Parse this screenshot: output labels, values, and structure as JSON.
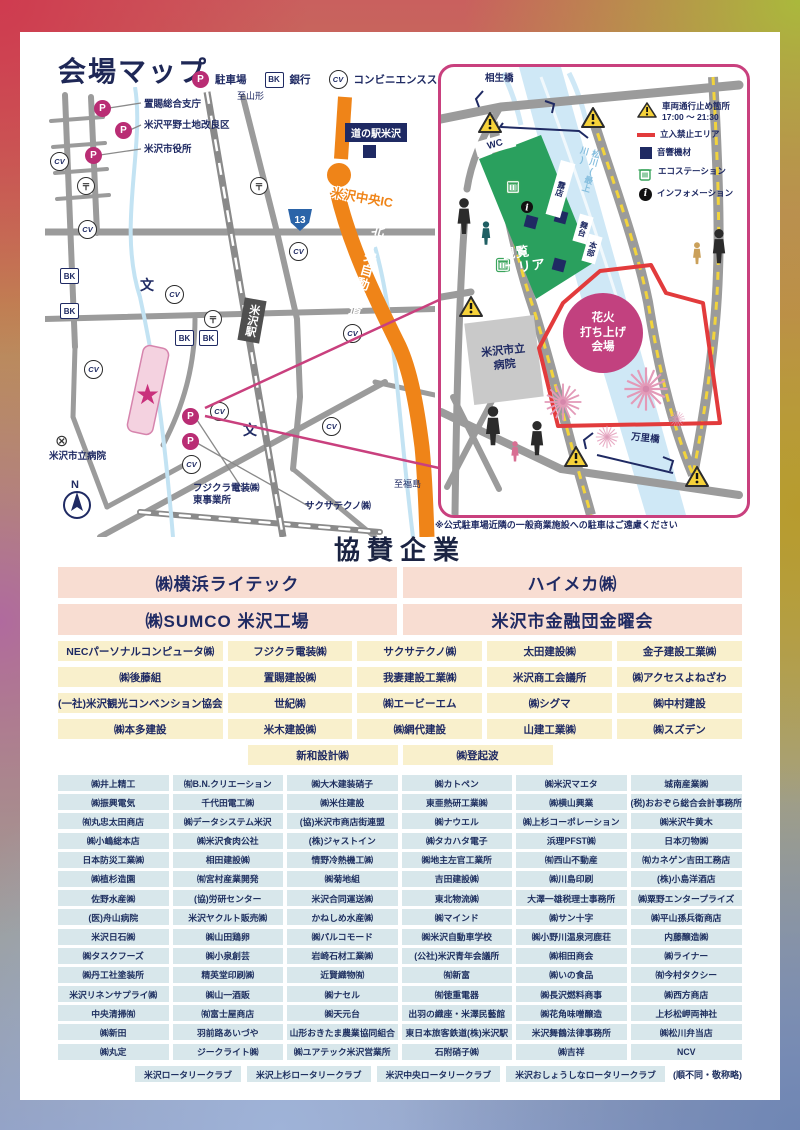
{
  "header": {
    "title": "会場マップ",
    "legend": [
      {
        "icon": "P",
        "label": "駐車場"
      },
      {
        "icon": "BK",
        "label": "銀行"
      },
      {
        "icon": "CV",
        "label": "コンビニエンスストア"
      }
    ]
  },
  "left_map": {
    "to_yamagata": "至山形",
    "to_fukushima": "至福島",
    "okitama": "置賜総合支庁",
    "kairyoku": "米沢平野土地改良区",
    "cityhall": "米沢市役所",
    "michinoeki": "道の駅米沢",
    "ic": "米沢中央IC",
    "expressway": "東北中央自動車道",
    "route13": "13",
    "station": "米沢駅",
    "hospital_label": "米沢市立病院",
    "fujikura": "フジクラ電装㈱\n東事業所",
    "saxa": "サクサテクノ㈱",
    "north": "N",
    "symbols": {
      "p": "P",
      "bk": "BK",
      "cv": "CV",
      "post": "〒",
      "school": "文",
      "hospital": "⊗",
      "star": "★"
    }
  },
  "inset_map": {
    "aioi": "相生橋",
    "banri": "万里橋",
    "wc": "WC",
    "roten": "露店",
    "stage": "舞台",
    "hq": "本部",
    "river": "松川(最上川)",
    "kanran": "観覧\nエリア",
    "hanabi": "花火\n打ち上げ\n会場",
    "hospital": "米沢市立\n病院",
    "legend": [
      {
        "label": "車両通行止め箇所",
        "sub": "17:00 〜 21:30"
      },
      {
        "label": "立入禁止エリア"
      },
      {
        "label": "音響機材"
      },
      {
        "label": "エコステーション"
      },
      {
        "label": "インフォメーション"
      }
    ],
    "note": "※公式駐車場近隣の一般商業施設への駐車はご遠慮ください"
  },
  "sponsors": {
    "title": "協賛企業",
    "tier1": [
      "㈱横浜ライテック",
      "ハイメカ㈱",
      "㈱SUMCO 米沢工場",
      "米沢市金融団金曜会"
    ],
    "tier2": [
      "NECパーソナルコンピュータ㈱",
      "フジクラ電装㈱",
      "サクサテクノ㈱",
      "太田建設㈱",
      "金子建設工業㈱",
      "㈱後藤組",
      "置賜建設㈱",
      "我妻建設工業㈱",
      "米沢商工会議所",
      "㈱アクセスよねざわ",
      "(一社)米沢観光コンベンション協会",
      "世紀㈱",
      "㈱エービーエム",
      "㈱シグマ",
      "㈱中村建設",
      "㈱本多建設",
      "米木建設㈱",
      "㈱網代建設",
      "山建工業㈱",
      "㈱スズデン"
    ],
    "tier2b": [
      "新和設計㈱",
      "㈱登起波"
    ],
    "tier3": [
      "㈱井上精工",
      "㈲B.N.クリエーション",
      "㈱大木建装硝子",
      "㈱カトペン",
      "㈱米沢マエタ",
      "城南産業㈱",
      "㈱振興電気",
      "千代田電工㈱",
      "㈱米住建設",
      "東亜熱研工業㈱",
      "㈱横山興業",
      "(税)おおぞら総合会計事務所",
      "㈲丸忠太田商店",
      "㈱データシステム米沢",
      "(協)米沢市商店街連盟",
      "㈱ナウエル",
      "㈱上杉コーポレーション",
      "㈱米沢牛黄木",
      "㈱小嶋総本店",
      "㈱米沢食肉公社",
      "(株)ジャストイン",
      "㈱タカハタ電子",
      "浜理PFST㈱",
      "日本刃物㈱",
      "日本防災工業㈱",
      "相田建設㈱",
      "情野冷熱機工㈱",
      "㈱地主左官工業所",
      "㈲西山不動産",
      "㈲カネゲン吉田工務店",
      "㈱植杉造園",
      "㈲宮村産業開発",
      "㈱菊地組",
      "吉田建設㈱",
      "㈱川島印刷",
      "(株)小島洋酒店",
      "佐野水産㈱",
      "(協)労研センター",
      "米沢合同運送㈱",
      "東北物流㈱",
      "大澤一雄税理士事務所",
      "㈱粟野エンタープライズ",
      "(医)舟山病院",
      "米沢ヤクルト販売㈱",
      "かねしめ水産㈱",
      "㈱マインド",
      "㈱サン十字",
      "㈱平山孫兵衛商店",
      "米沢日石㈱",
      "㈱山田鶏卵",
      "㈱パルコモード",
      "㈱米沢自動車学校",
      "㈱小野川温泉河鹿荘",
      "内藤醸造㈱",
      "㈱タスクフーズ",
      "㈱小泉創芸",
      "岩崎石材工業㈱",
      "(公社)米沢青年会議所",
      "㈱相田商会",
      "㈱ライナー",
      "㈱丹工社塗装所",
      "精英堂印刷㈱",
      "近賢織物㈲",
      "㈲新富",
      "㈱いの食品",
      "㈲今村タクシー",
      "米沢リネンサプライ㈱",
      "㈱山一酒販",
      "㈱ナセル",
      "㈲徳重電器",
      "㈱長沢燃料商事",
      "㈱西方商店",
      "中央清掃㈲",
      "㈲富士屋商店",
      "㈱天元台",
      "出羽の織座・米澤民藝館",
      "㈱花角味噌醸造",
      "上杉松岬両神社",
      "㈱新田",
      "羽前路あいづや",
      "山形おきたま農業協同組合",
      "東日本旅客鉄道(株)米沢駅",
      "米沢舞鶴法律事務所",
      "㈱松川弁当店",
      "㈱丸定",
      "ジークライト㈱",
      "㈱ユアテック米沢営業所",
      "石附硝子㈱",
      "㈱吉祥",
      "NCV"
    ],
    "tier4": [
      "米沢ロータリークラブ",
      "米沢上杉ロータリークラブ",
      "米沢中央ロータリークラブ",
      "米沢おしょうしなロータリークラブ"
    ],
    "note": "(順不同・敬称略)"
  }
}
